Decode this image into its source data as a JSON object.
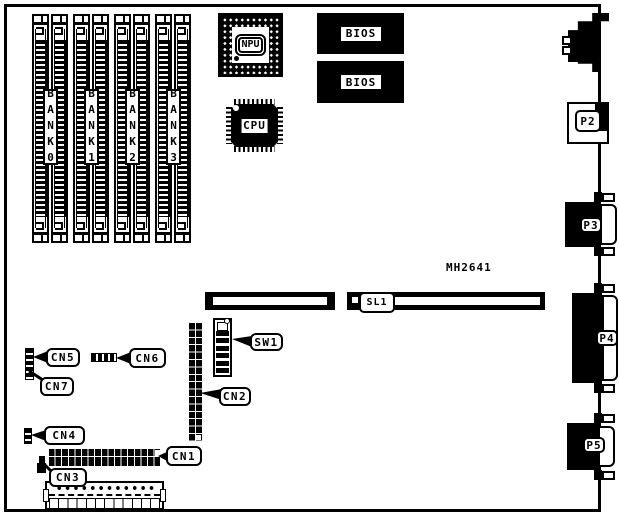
{
  "board": {
    "model_text": "MH2641"
  },
  "memory_banks": [
    {
      "label": "BANK0"
    },
    {
      "label": "BANK1"
    },
    {
      "label": "BANK2"
    },
    {
      "label": "BANK3"
    }
  ],
  "chips": {
    "npu": {
      "label": "NPU"
    },
    "cpu": {
      "label": "CPU"
    },
    "bios_top": {
      "label": "BIOS"
    },
    "bios_bottom": {
      "label": "BIOS"
    }
  },
  "expansion_slot": {
    "label": "SL1"
  },
  "ports": {
    "p2": {
      "label": "P2"
    },
    "p3": {
      "label": "P3"
    },
    "p4": {
      "label": "P4"
    },
    "p5": {
      "label": "P5"
    }
  },
  "callouts": {
    "cn1": {
      "label": "CN1"
    },
    "cn2": {
      "label": "CN2"
    },
    "cn3": {
      "label": "CN3"
    },
    "cn4": {
      "label": "CN4"
    },
    "cn5": {
      "label": "CN5"
    },
    "cn6": {
      "label": "CN6"
    },
    "cn7": {
      "label": "CN7"
    },
    "sw1": {
      "label": "SW1"
    }
  },
  "colors": {
    "ink": "#000000",
    "paper": "#ffffff"
  }
}
